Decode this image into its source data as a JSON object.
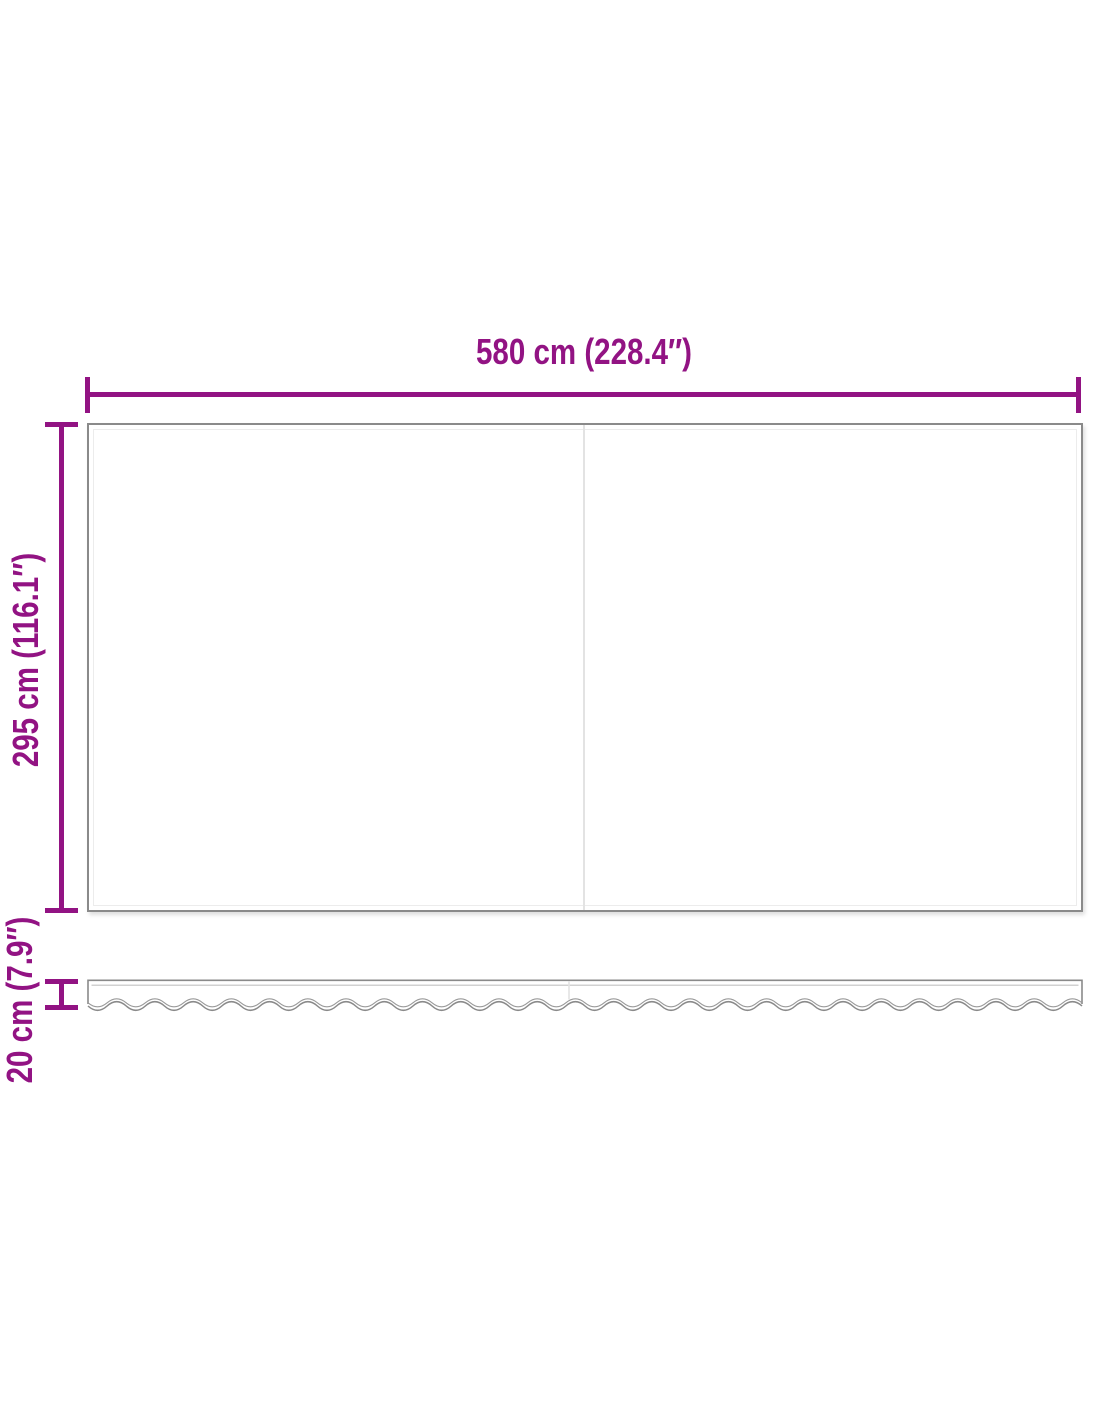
{
  "dimensions": {
    "width": {
      "label": "580 cm (228.4″)",
      "value_cm": 580,
      "value_in": 228.4
    },
    "height": {
      "label": "295 cm (116.1″)",
      "value_cm": 295,
      "value_in": 116.1
    },
    "valance": {
      "label": "20 cm (7.9″)",
      "value_cm": 20,
      "value_in": 7.9
    }
  },
  "colors": {
    "dimension_accent": "#921383",
    "panel_outline": "#8a8a8a",
    "panel_inner_line": "#ececec",
    "seam": "#e3e3e3",
    "background": "#ffffff"
  }
}
